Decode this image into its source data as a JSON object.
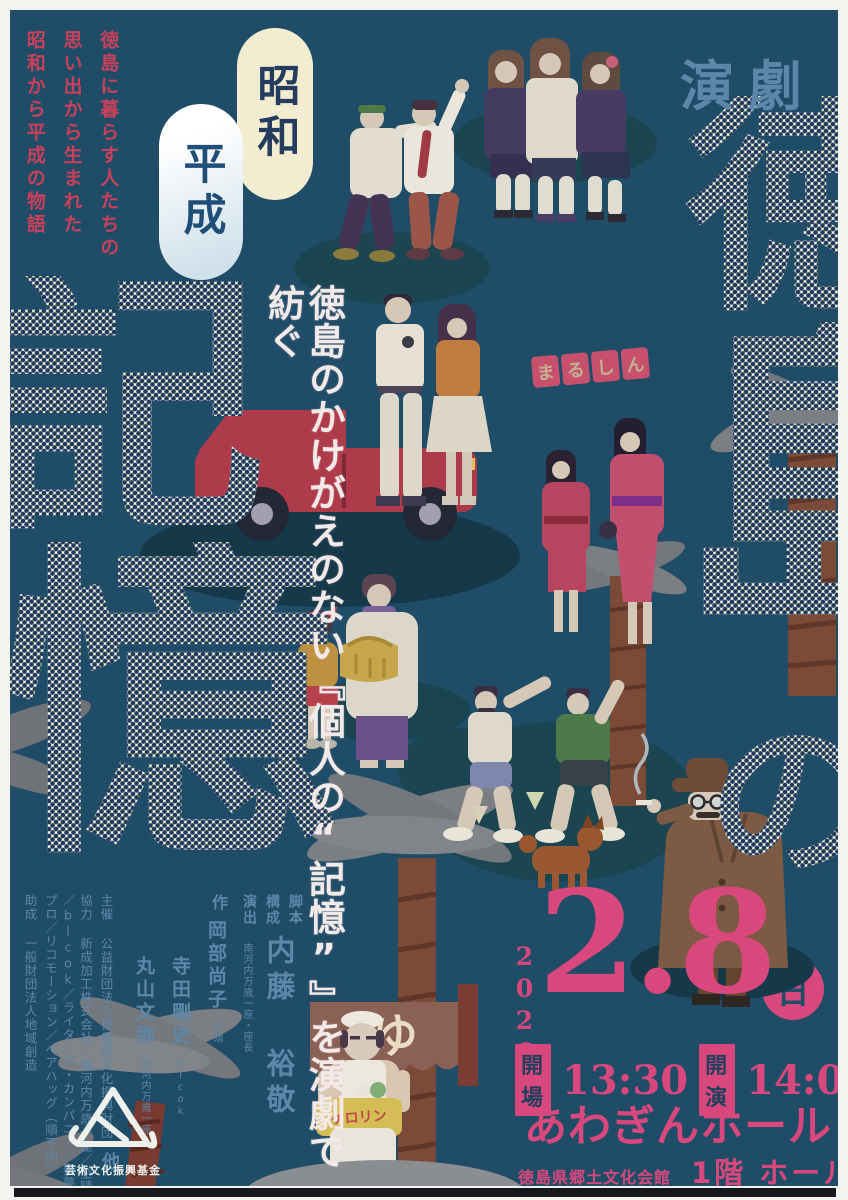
{
  "palette": {
    "background": "#1f4d68",
    "accent_pink": "#d8487c",
    "tagline_red": "#c84059",
    "steel_blue": "#5d87a8",
    "cream_pill": "#f2ecd0",
    "halftone_navy": "#20395c",
    "halftone_accent": "#c5d44e",
    "ink_white": "#f2e9e9"
  },
  "header": {
    "genre": "演劇",
    "tagline_lines": [
      "徳島に暮らす人たちの",
      "思い出から生まれた",
      "昭和から平成の物語"
    ],
    "era_pill_1": "昭和",
    "era_pill_2": "平成"
  },
  "title": {
    "full": "徳島の記憶",
    "char_1": "徳",
    "char_2": "島",
    "char_3": "の",
    "char_4": "記",
    "char_5": "憶"
  },
  "subtitle": "徳島のかけがえのない『個人の“記憶”』を演劇で紡ぐ",
  "credits": {
    "role_1": "脚本",
    "role_2": "構成",
    "role_3": "演出",
    "writer_affiliation": "南河内万歳一座・座長",
    "writer_name": "内藤 裕敬",
    "saku_label": "作",
    "author_1": "岡部尚子",
    "author_1_affiliation": "空晴",
    "author_2": "寺田剛史",
    "author_2_affiliation": "blcok",
    "author_3": "丸山文弥",
    "author_3_affiliation": "南河内万歳一座",
    "authors_etc": "他",
    "organizer_line": "主催 公益財団法人徳島県文化振興財団",
    "cooperation_line": "協力 新成加工株式会社／南河内万歳一座／空晴／blcok／ライターズ・カンパニー／舞夢プロ／リコモーション／ベアハッグ（順不同）",
    "grant_line": "助成 一般財団法人地域創造",
    "fund_logo_text": "芸術文化振興基金"
  },
  "event": {
    "year": "2026",
    "date": "2.8",
    "weekday": "日",
    "doors_label": "開場",
    "doors_time": "13:30",
    "curtain_label": "開演",
    "curtain_time": "14:00",
    "venue": "あわぎんホール",
    "venue_building": "徳島県郷土文化会館",
    "venue_floor": "1階 ホール"
  },
  "scene": {
    "marushin_1": "ま",
    "marushin_2": "る",
    "marushin_3": "し",
    "marushin_4": "ん",
    "noren": "ゆ",
    "basin": "ケロリン"
  }
}
